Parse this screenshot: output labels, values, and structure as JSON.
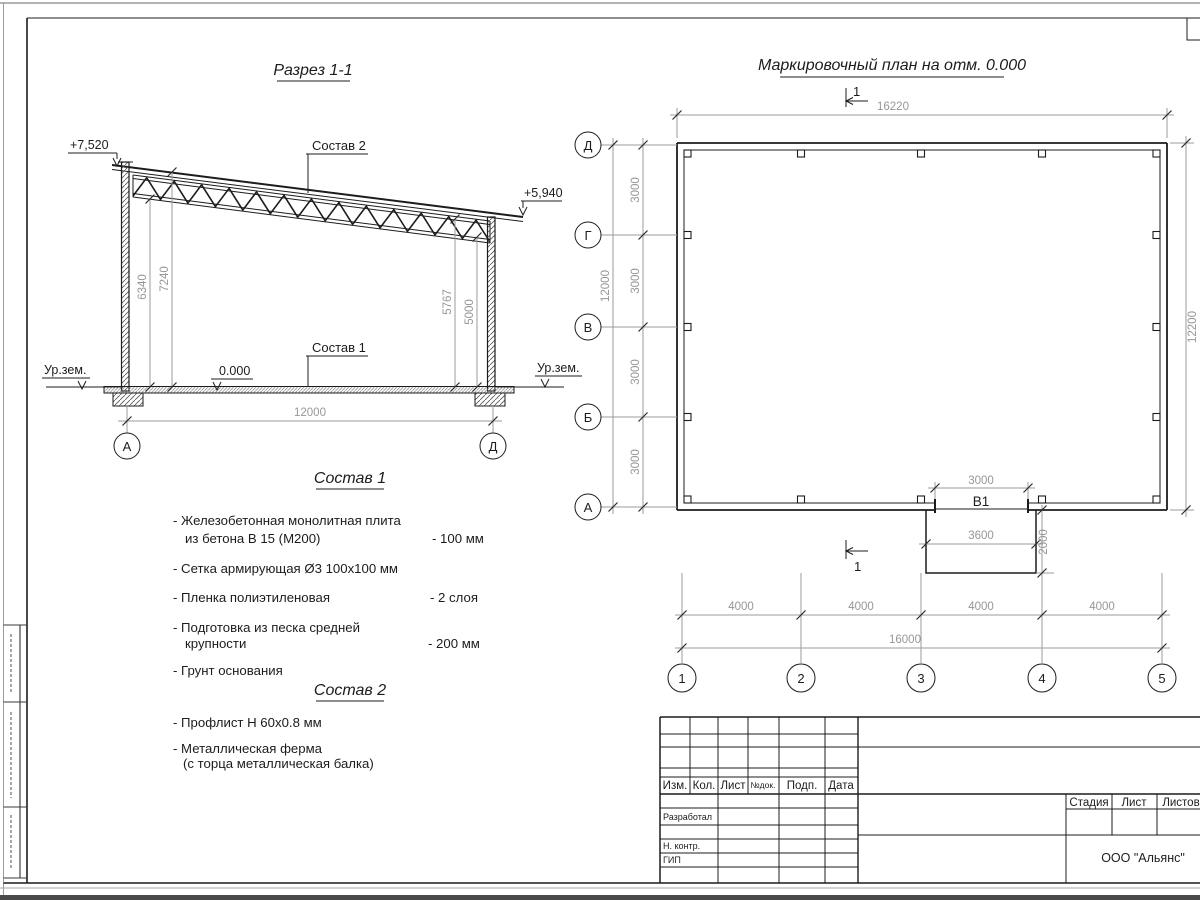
{
  "section": {
    "title": "Разрез 1-1",
    "elev_left": "+7,520",
    "elev_right": "+5,940",
    "label_sostav2": "Состав 2",
    "label_sostav1": "Состав 1",
    "level_zero": "0.000",
    "ground_left": "Ур.зем.",
    "ground_right": "Ур.зем.",
    "dim_h_left1": "6340",
    "dim_h_left2": "7240",
    "dim_h_right1": "5767",
    "dim_h_right2": "5000",
    "dim_width": "12000",
    "axis_left": "А",
    "axis_right": "Д"
  },
  "plan": {
    "title": "Маркировочный план на отм. 0.000",
    "section_mark_top": "1",
    "section_mark_bottom": "1",
    "dim_top": "16220",
    "dim_right": "12200",
    "dim_left_total": "12000",
    "dim_left_segments": [
      "3000",
      "3000",
      "3000",
      "3000"
    ],
    "row_axes": [
      "Д",
      "Г",
      "В",
      "Б",
      "А"
    ],
    "col_axes": [
      "1",
      "2",
      "3",
      "4",
      "5"
    ],
    "opening_label": "В1",
    "opening_dim": "3000",
    "porch_width": "3600",
    "porch_depth": "2000",
    "dim_bottom_segments": [
      "4000",
      "4000",
      "4000",
      "4000"
    ],
    "dim_bottom_total": "16000"
  },
  "sostav1": {
    "title": "Состав 1",
    "line1a": "- Железобетонная  монолитная плита",
    "line1b": "из бетона В 15 (М200)",
    "val1": "- 100 мм",
    "line2": "- Сетка армирующая Ø3 100х100 мм",
    "line3": "- Пленка полиэтиленовая",
    "val3": "-  2 слоя",
    "line4a": "- Подготовка из песка средней",
    "line4b": "крупности",
    "val4": "- 200 мм",
    "line5": "- Грунт основания"
  },
  "sostav2": {
    "title": "Состав 2",
    "line1": "- Профлист Н 60х0.8 мм",
    "line2a": "- Металлическая ферма",
    "line2b": "(с торца металлическая балка)"
  },
  "titleblock": {
    "header": [
      "Изм.",
      "Кол.",
      "Лист",
      "№док.",
      "Подп.",
      "Дата"
    ],
    "roles": [
      "Разработал",
      "Н. контр.",
      "ГИП"
    ],
    "stage_header": [
      "Стадия",
      "Лист",
      "Листов"
    ],
    "company": "ООО \"Альянс\""
  }
}
